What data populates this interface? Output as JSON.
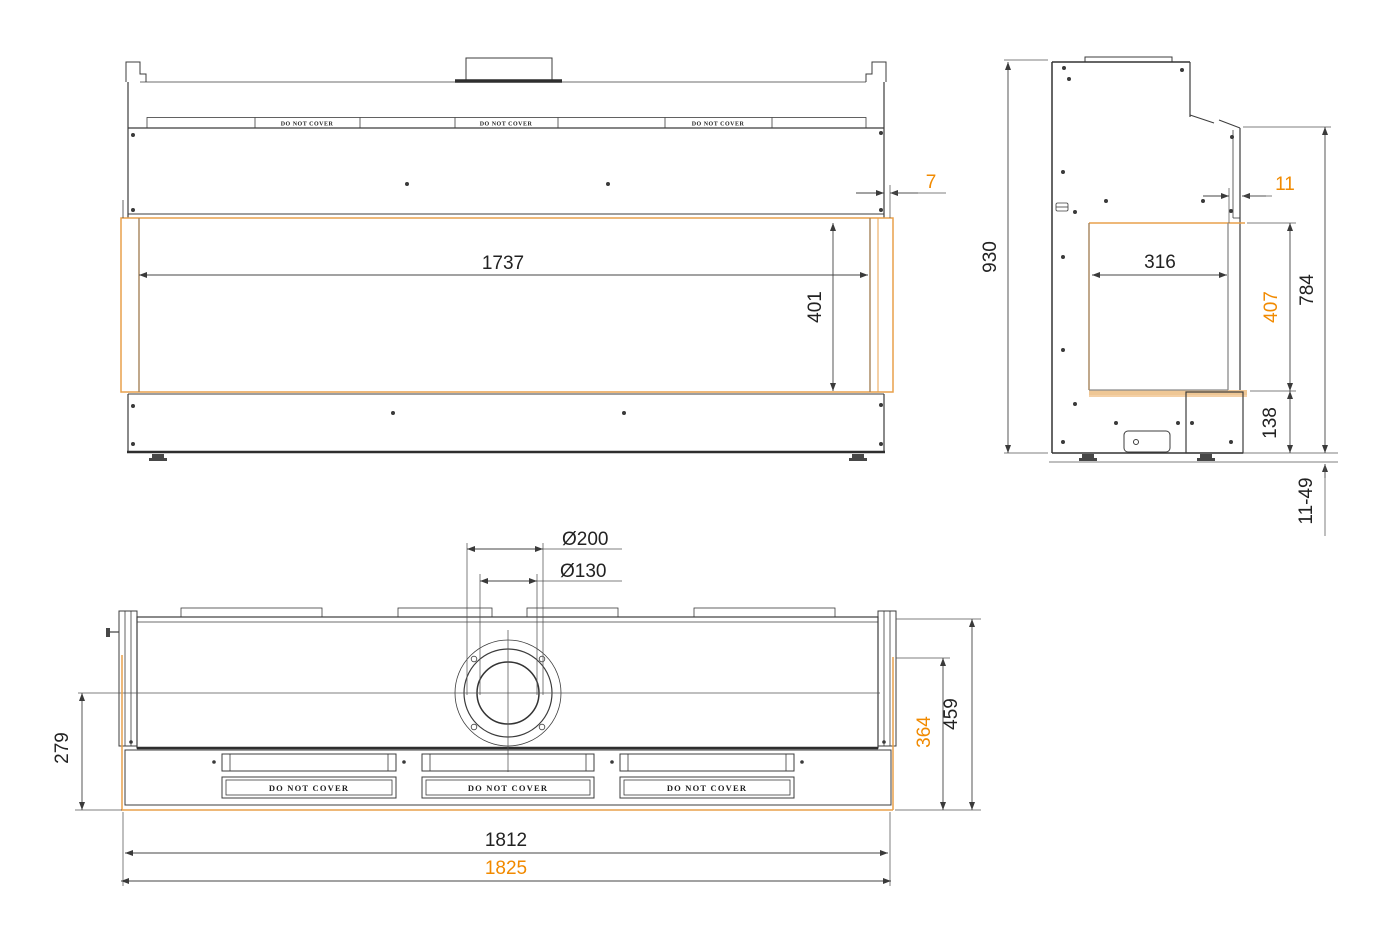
{
  "colors": {
    "accent_orange": "#F18A00",
    "glass_orange": "#E8A14C",
    "tan": "#EFC795",
    "line_dark": "#3C3C3C"
  },
  "front_view": {
    "do_not_cover": "DO NOT COVER",
    "dim_opening_width": "1737",
    "dim_opening_height": "401",
    "dim_glass_offset": "7"
  },
  "side_view": {
    "dim_total_height": "930",
    "dim_glass_thickness": "11",
    "dim_opening_depth": "316",
    "dim_opening_height": "407",
    "dim_front_height": "784",
    "dim_base_height": "138",
    "dim_feet_range": "11-49"
  },
  "plan_view": {
    "do_not_cover": "DO NOT COVER",
    "dim_flue_outer": "Ø200",
    "dim_flue_inner": "Ø130",
    "dim_center_to_front": "279",
    "dim_glass_depth": "364",
    "dim_total_depth": "459",
    "dim_body_width": "1812",
    "dim_glass_width": "1825"
  }
}
